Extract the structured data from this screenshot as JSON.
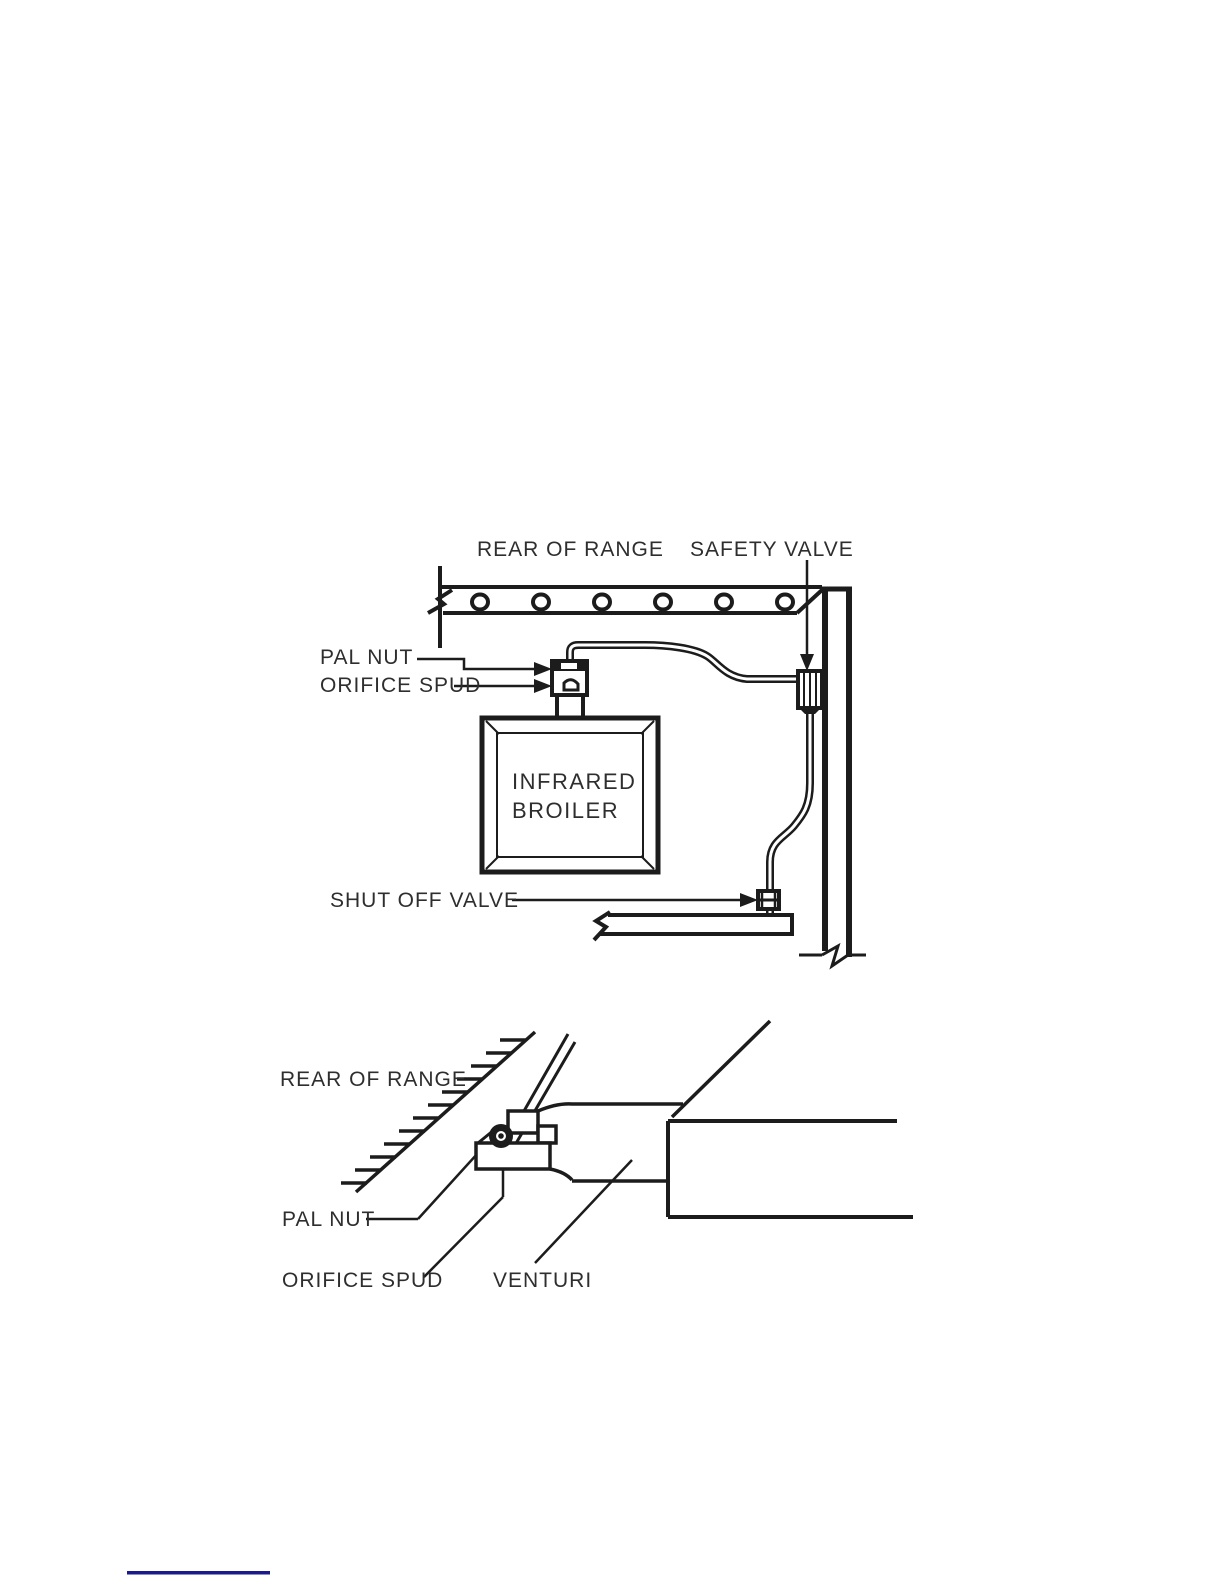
{
  "page": {
    "background": "#ffffff",
    "link_rule_color": "#1a1a8c"
  },
  "colors": {
    "line": "#1c1c1c",
    "text": "#2e2e2e"
  },
  "figure_top": {
    "description": "infrared broiler gas supply diagram",
    "labels": {
      "rear_of_range": "REAR OF RANGE",
      "safety_valve": "SAFETY VALVE",
      "pal_nut": "PAL NUT",
      "orifice_spud": "ORIFICE SPUD",
      "broiler_line1": "INFRARED",
      "broiler_line2": "BROILER",
      "shut_off_valve": "SHUT OFF VALVE"
    }
  },
  "figure_bottom": {
    "description": "venturi and orifice spud detail diagram",
    "labels": {
      "rear_of_range": "REAR OF RANGE",
      "pal_nut": "PAL NUT",
      "orifice_spud": "ORIFICE SPUD",
      "venturi": "VENTURI"
    }
  }
}
